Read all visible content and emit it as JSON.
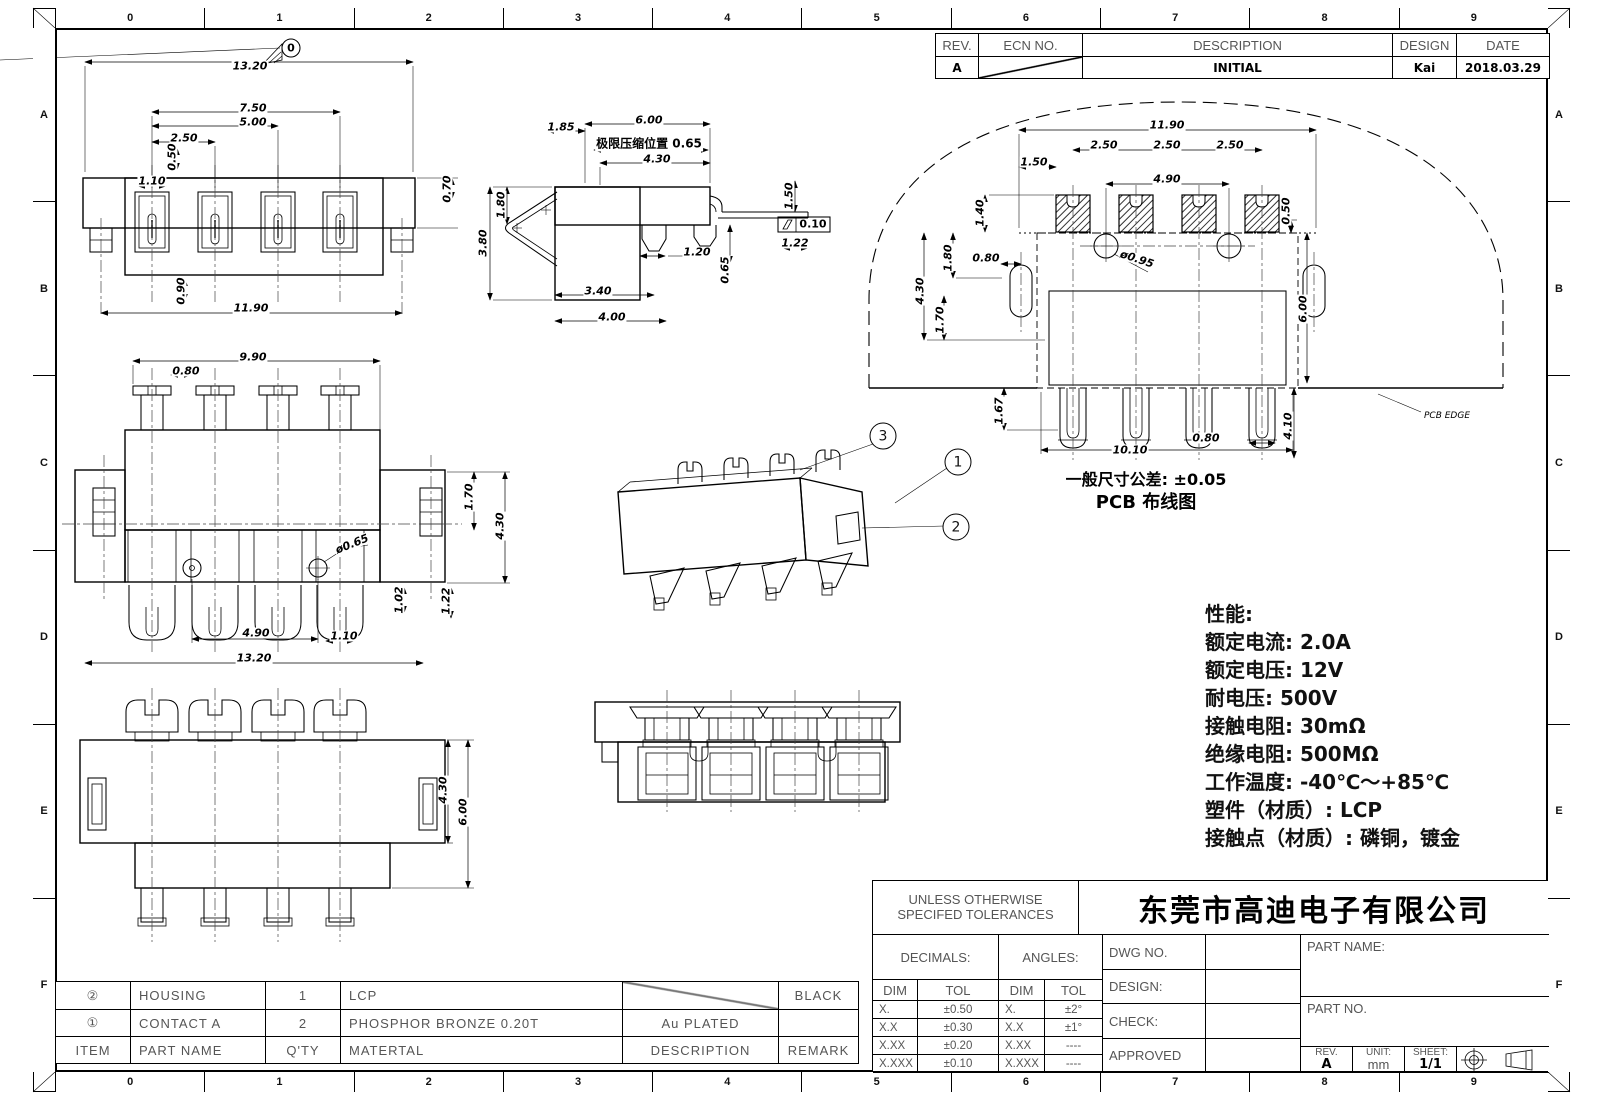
{
  "sheet": {
    "bg": "#ffffff",
    "line_color": "#000000",
    "grid_numbers": [
      "0",
      "1",
      "2",
      "3",
      "4",
      "5",
      "6",
      "7",
      "8",
      "9"
    ],
    "grid_letters": [
      "A",
      "B",
      "C",
      "D",
      "E",
      "F"
    ]
  },
  "rev_table": {
    "headers": [
      "REV.",
      "ECN NO.",
      "DESCRIPTION",
      "DESIGN",
      "DATE"
    ],
    "rows": [
      {
        "rev": "A",
        "ecn": "",
        "description": "INITIAL",
        "design": "Kai",
        "date": "2018.03.29"
      }
    ]
  },
  "specs": {
    "lines": [
      "性能:",
      "额定电流: 2.0A",
      "额定电压: 12V",
      "耐电压: 500V",
      "接触电阻: 30mΩ",
      "绝缘电阻: 500MΩ",
      "工作温度: -40℃～+85℃",
      "塑件（材质）: LCP",
      "接触点（材质）: 磷铜，镀金"
    ]
  },
  "tolerance_block": {
    "title_line1": "UNLESS OTHERWISE",
    "title_line2": "SPECIFED TOLERANCES",
    "decimals_label": "DECIMALS:",
    "angles_label": "ANGLES:",
    "col_headers": [
      "DIM",
      "TOL"
    ],
    "decimals_rows": [
      [
        "X.",
        "±0.50"
      ],
      [
        "X.X",
        "±0.30"
      ],
      [
        "X.XX",
        "±0.20"
      ],
      [
        "X.XXX",
        "±0.10"
      ]
    ],
    "angles_rows": [
      [
        "X.",
        "±2°"
      ],
      [
        "X.X",
        "±1°"
      ],
      [
        "X.XX",
        "----"
      ],
      [
        "X.XXX",
        "----"
      ]
    ]
  },
  "title_block": {
    "company": "东莞市高迪电子有限公司",
    "dwg_no_label": "DWG NO.",
    "design_label": "DESIGN:",
    "check_label": "CHECK:",
    "approved_label": "APPROVED",
    "part_name_label": "PART NAME:",
    "part_no_label": "PART NO.",
    "rev_label": "REV.",
    "rev_value": "A",
    "unit_label": "UNIT:",
    "unit_value": "mm",
    "sheet_label": "SHEET:",
    "sheet_value": "1/1"
  },
  "bom": {
    "headers": [
      "ITEM",
      "PART NAME",
      "Q'TY",
      "MATERTAL",
      "DESCRIPTION",
      "REMARK"
    ],
    "rows": [
      {
        "item": "②",
        "part_name": "HOUSING",
        "qty": "1",
        "material": "LCP",
        "description": "",
        "remark": "BLACK"
      },
      {
        "item": "①",
        "part_name": "CONTACT A",
        "qty": "2",
        "material": "PHOSPHOR BRONZE 0.20T",
        "description": "Au PLATED",
        "remark": ""
      }
    ]
  },
  "drawing": {
    "callouts": [
      {
        "n": "3",
        "x": 883,
        "y": 436
      },
      {
        "n": "1",
        "x": 958,
        "y": 462
      },
      {
        "n": "2",
        "x": 956,
        "y": 527
      }
    ],
    "labels": [
      {
        "x": 250,
        "y": 66,
        "t": "13.20"
      },
      {
        "x": 291,
        "y": 48,
        "t": "0",
        "cls": "flag"
      },
      {
        "x": 253,
        "y": 108,
        "t": "7.50"
      },
      {
        "x": 253,
        "y": 122,
        "t": "5.00"
      },
      {
        "x": 184,
        "y": 138,
        "t": "2.50"
      },
      {
        "x": 172,
        "y": 157,
        "t": "0.50",
        "r": -90
      },
      {
        "x": 152,
        "y": 181,
        "t": "1.10"
      },
      {
        "x": 447,
        "y": 189,
        "t": "0.70",
        "r": -90
      },
      {
        "x": 181,
        "y": 291,
        "t": "0.90",
        "r": -90
      },
      {
        "x": 251,
        "y": 308,
        "t": "11.90"
      },
      {
        "x": 561,
        "y": 127,
        "t": "1.85"
      },
      {
        "x": 649,
        "y": 120,
        "t": "6.00"
      },
      {
        "x": 649,
        "y": 143,
        "t": "极限压缩位置 0.65",
        "cls": "cjk"
      },
      {
        "x": 657,
        "y": 159,
        "t": "4.30"
      },
      {
        "x": 501,
        "y": 205,
        "t": "1.80",
        "r": -90
      },
      {
        "x": 483,
        "y": 243,
        "t": "3.80",
        "r": -90
      },
      {
        "x": 789,
        "y": 196,
        "t": "1.50",
        "r": -90
      },
      {
        "x": 813,
        "y": 224,
        "t": "0.10",
        "cls": "gdt"
      },
      {
        "x": 795,
        "y": 243,
        "t": "1.22"
      },
      {
        "x": 697,
        "y": 252,
        "t": "1.20"
      },
      {
        "x": 725,
        "y": 270,
        "t": "0.65",
        "r": -90
      },
      {
        "x": 598,
        "y": 291,
        "t": "3.40"
      },
      {
        "x": 612,
        "y": 317,
        "t": "4.00"
      },
      {
        "x": 253,
        "y": 357,
        "t": "9.90"
      },
      {
        "x": 186,
        "y": 371,
        "t": "0.80"
      },
      {
        "x": 469,
        "y": 497,
        "t": "1.70",
        "r": -90
      },
      {
        "x": 500,
        "y": 526,
        "t": "4.30",
        "r": -90
      },
      {
        "x": 352,
        "y": 544,
        "t": "ø0.65",
        "r": -22
      },
      {
        "x": 399,
        "y": 600,
        "t": "1.02",
        "r": -90
      },
      {
        "x": 446,
        "y": 601,
        "t": "1.22",
        "r": -90
      },
      {
        "x": 256,
        "y": 633,
        "t": "4.90"
      },
      {
        "x": 344,
        "y": 636,
        "t": "1.10"
      },
      {
        "x": 254,
        "y": 658,
        "t": "13.20"
      },
      {
        "x": 443,
        "y": 790,
        "t": "4.30",
        "r": -90
      },
      {
        "x": 463,
        "y": 812,
        "t": "6.00",
        "r": -90
      },
      {
        "x": 1167,
        "y": 125,
        "t": "11.90"
      },
      {
        "x": 1104,
        "y": 145,
        "t": "2.50"
      },
      {
        "x": 1167,
        "y": 145,
        "t": "2.50"
      },
      {
        "x": 1230,
        "y": 145,
        "t": "2.50"
      },
      {
        "x": 1034,
        "y": 162,
        "t": "1.50"
      },
      {
        "x": 1167,
        "y": 179,
        "t": "4.90"
      },
      {
        "x": 980,
        "y": 213,
        "t": "1.40",
        "r": -90
      },
      {
        "x": 1286,
        "y": 211,
        "t": "0.50",
        "r": -90
      },
      {
        "x": 948,
        "y": 258,
        "t": "1.80",
        "r": -90
      },
      {
        "x": 986,
        "y": 258,
        "t": "0.80"
      },
      {
        "x": 1137,
        "y": 259,
        "t": "ø0.95",
        "r": 18
      },
      {
        "x": 920,
        "y": 291,
        "t": "4.30",
        "r": -90
      },
      {
        "x": 940,
        "y": 320,
        "t": "1.70",
        "r": -90
      },
      {
        "x": 1303,
        "y": 309,
        "t": "6.00",
        "r": -90
      },
      {
        "x": 999,
        "y": 411,
        "t": "1.67",
        "r": -90
      },
      {
        "x": 1206,
        "y": 438,
        "t": "0.80"
      },
      {
        "x": 1130,
        "y": 450,
        "t": "10.10"
      },
      {
        "x": 1288,
        "y": 426,
        "t": "4.10",
        "r": -90
      },
      {
        "x": 1447,
        "y": 416,
        "t": "PCB EDGE",
        "cls": "small"
      },
      {
        "x": 1146,
        "y": 478,
        "t": "一般尺寸公差: ±0.05",
        "cls": "note"
      },
      {
        "x": 1146,
        "y": 501,
        "t": "PCB 布线图",
        "cls": "note2"
      }
    ]
  }
}
